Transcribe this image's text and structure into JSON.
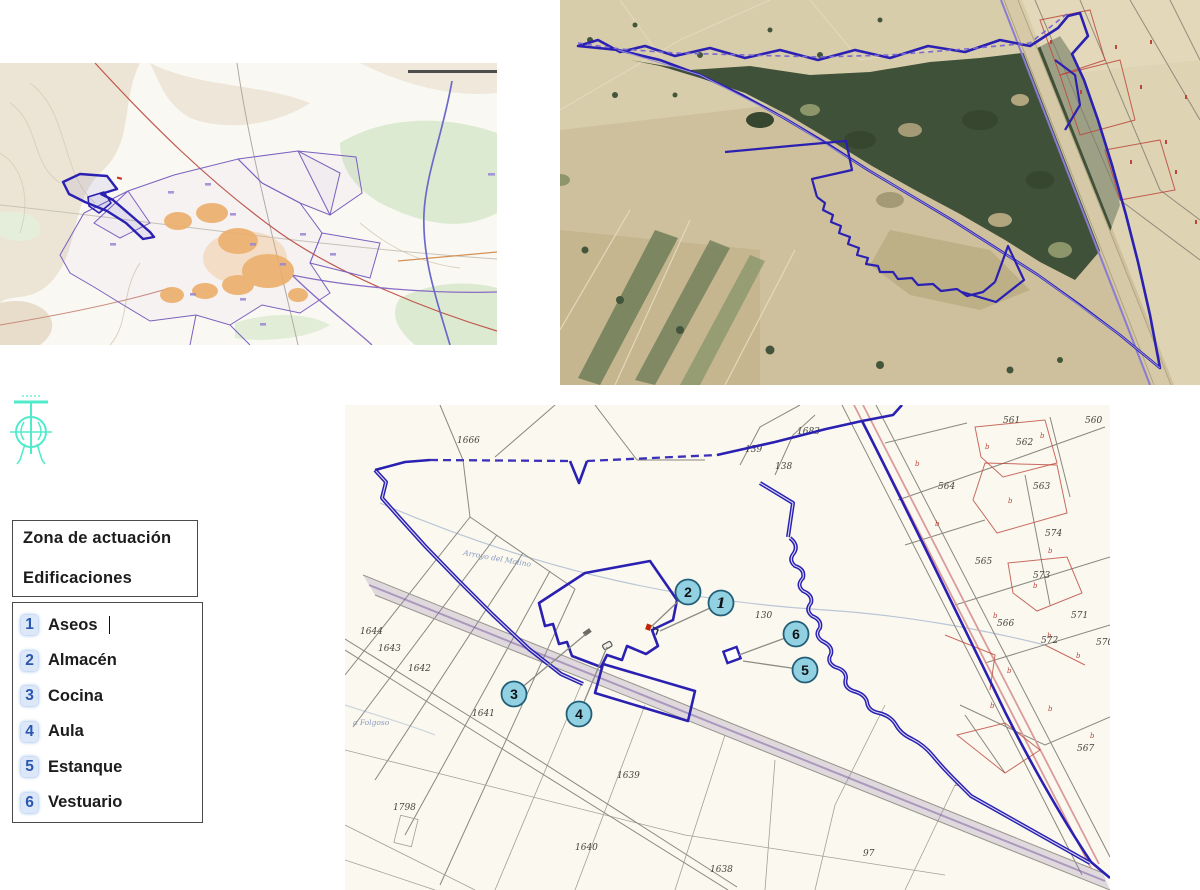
{
  "colors": {
    "zone_outline": "#2a1fb8",
    "marker_fill": "#8fd2e2",
    "marker_border": "#1f5f7a",
    "legend_number": "#2b57b0",
    "cad_symbol": "#3fe9c6",
    "red_parcel": "#c0453a"
  },
  "legend_zone": {
    "line1": "Zona de actuación",
    "line2": "Edificaciones"
  },
  "legend_buildings": {
    "items": [
      {
        "num": "1",
        "label": "Aseos",
        "cursor": true
      },
      {
        "num": "2",
        "label": "Almacén"
      },
      {
        "num": "3",
        "label": "Cocina"
      },
      {
        "num": "4",
        "label": "Aula"
      },
      {
        "num": "5",
        "label": "Estanque"
      },
      {
        "num": "6",
        "label": "Vestuario"
      }
    ]
  },
  "cadastral": {
    "stream_label": "Arroyo del Molino",
    "stream_label2": "a Folgoso",
    "parcel_labels": [
      {
        "t": "1666",
        "x": 112,
        "y": 38
      },
      {
        "t": "139",
        "x": 400,
        "y": 47
      },
      {
        "t": "138",
        "x": 430,
        "y": 64
      },
      {
        "t": "1683",
        "x": 452,
        "y": 29
      },
      {
        "t": "561",
        "x": 658,
        "y": 18
      },
      {
        "t": "560",
        "x": 740,
        "y": 18
      },
      {
        "t": "562",
        "x": 671,
        "y": 40
      },
      {
        "t": "563",
        "x": 688,
        "y": 84
      },
      {
        "t": "564",
        "x": 593,
        "y": 84
      },
      {
        "t": "574",
        "x": 700,
        "y": 131
      },
      {
        "t": "573",
        "x": 688,
        "y": 173
      },
      {
        "t": "565",
        "x": 630,
        "y": 159
      },
      {
        "t": "571",
        "x": 726,
        "y": 213
      },
      {
        "t": "566",
        "x": 652,
        "y": 221
      },
      {
        "t": "572",
        "x": 696,
        "y": 238
      },
      {
        "t": "570",
        "x": 751,
        "y": 240
      },
      {
        "t": "567",
        "x": 732,
        "y": 346
      },
      {
        "t": "130",
        "x": 410,
        "y": 213
      },
      {
        "t": "1644",
        "x": 15,
        "y": 229
      },
      {
        "t": "1643",
        "x": 33,
        "y": 246
      },
      {
        "t": "1642",
        "x": 63,
        "y": 266
      },
      {
        "t": "1641",
        "x": 127,
        "y": 311
      },
      {
        "t": "1639",
        "x": 272,
        "y": 373
      },
      {
        "t": "1798",
        "x": 48,
        "y": 405
      },
      {
        "t": "1640",
        "x": 230,
        "y": 445
      },
      {
        "t": "97",
        "x": 518,
        "y": 451
      },
      {
        "t": "1638",
        "x": 365,
        "y": 467
      }
    ],
    "markers": [
      {
        "num": "1",
        "x": 376,
        "y": 198,
        "tx": 315,
        "ty": 226,
        "italic": true
      },
      {
        "num": "2",
        "x": 343,
        "y": 187,
        "tx": 306,
        "ty": 222
      },
      {
        "num": "3",
        "x": 169,
        "y": 289,
        "tx": 241,
        "ty": 229
      },
      {
        "num": "4",
        "x": 234,
        "y": 309,
        "tx": 262,
        "ty": 242
      },
      {
        "num": "5",
        "x": 460,
        "y": 265,
        "tx": 398,
        "ty": 256
      },
      {
        "num": "6",
        "x": 451,
        "y": 229,
        "tx": 394,
        "ty": 250
      }
    ],
    "red_marks": [
      {
        "c": "b",
        "x": 640,
        "y": 44
      },
      {
        "c": "b",
        "x": 695,
        "y": 33
      },
      {
        "c": "b",
        "x": 663,
        "y": 98
      },
      {
        "c": "b",
        "x": 703,
        "y": 148
      },
      {
        "c": "b",
        "x": 688,
        "y": 183
      },
      {
        "c": "b",
        "x": 648,
        "y": 213
      },
      {
        "c": "b",
        "x": 702,
        "y": 233
      },
      {
        "c": "b",
        "x": 662,
        "y": 268
      },
      {
        "c": "b",
        "x": 731,
        "y": 253
      },
      {
        "c": "b",
        "x": 645,
        "y": 303
      },
      {
        "c": "b",
        "x": 703,
        "y": 306
      },
      {
        "c": "b",
        "x": 745,
        "y": 333
      },
      {
        "c": "b",
        "x": 610,
        "y": 381
      },
      {
        "c": "b",
        "x": 590,
        "y": 121
      },
      {
        "c": "b",
        "x": 570,
        "y": 61
      }
    ]
  }
}
